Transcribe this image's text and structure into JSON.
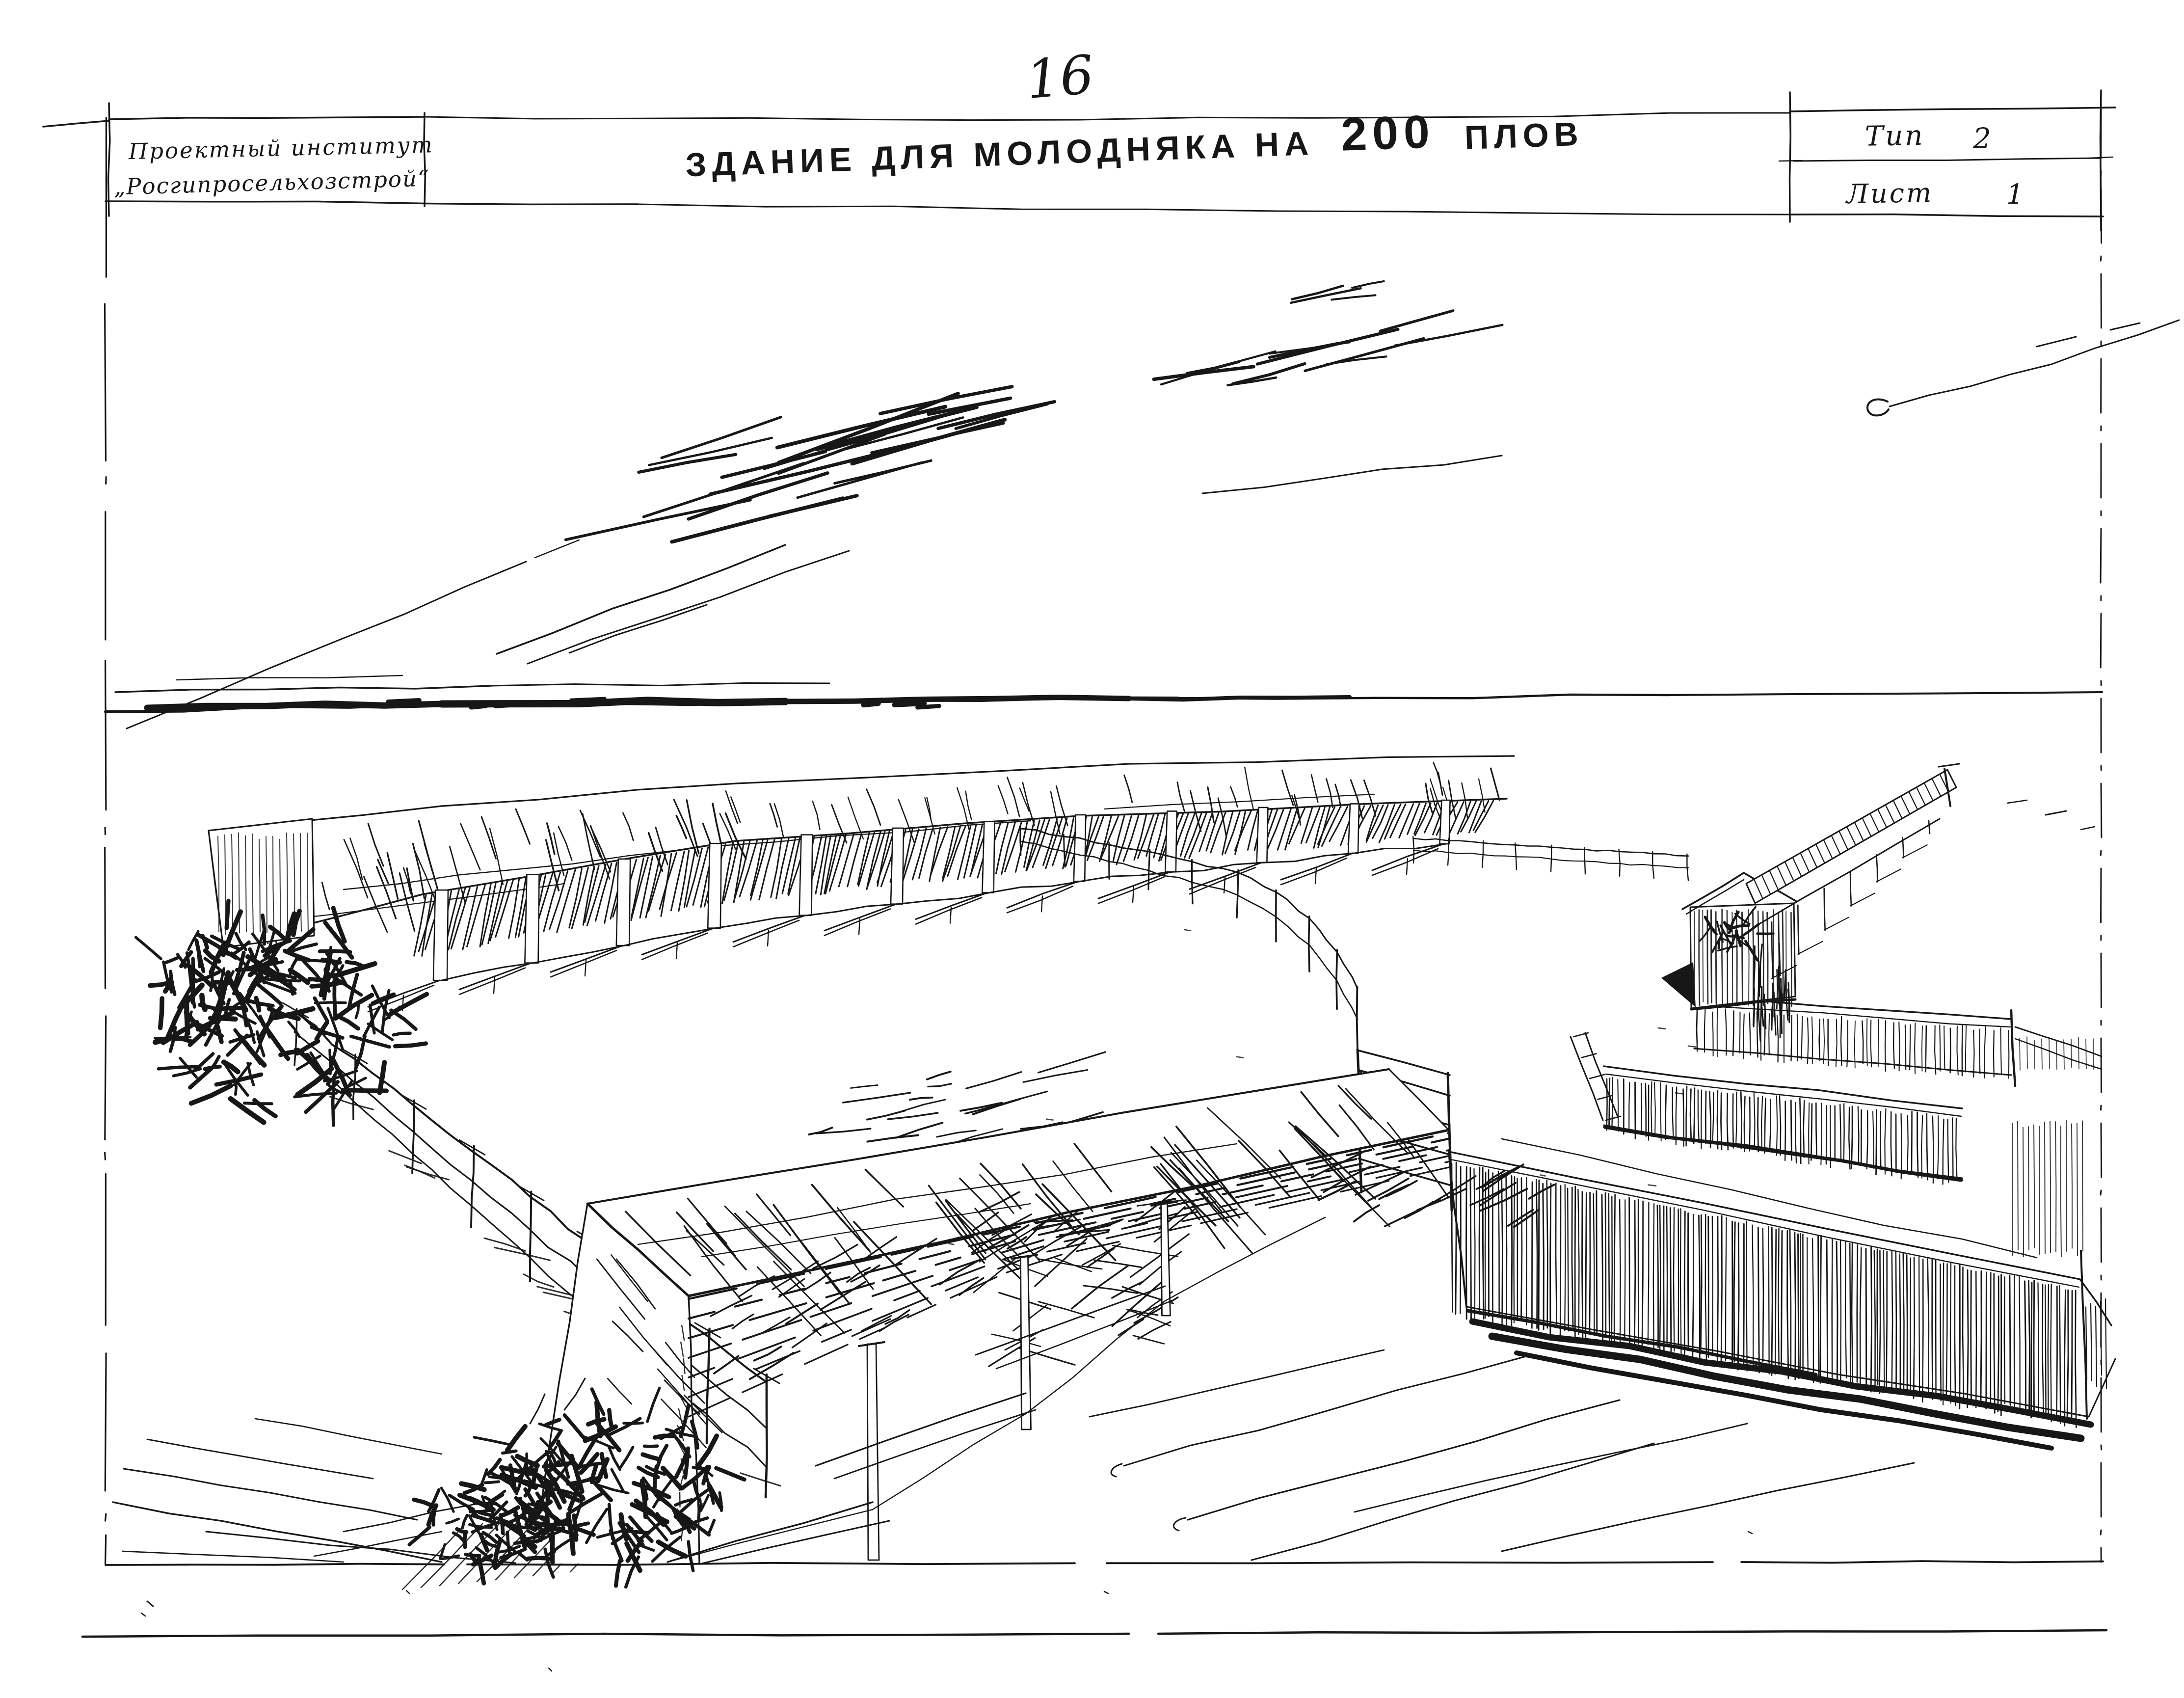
{
  "page": {
    "number": "16"
  },
  "title_block": {
    "institute_line1": "Проектный институт",
    "institute_line2": "„Росгипросельхозстрой“",
    "type_label": "Тип",
    "type_value": "2",
    "sheet_label": "Лист",
    "sheet_value": "1"
  },
  "drawing_title": {
    "part1": "ЗДАНИЕ ДЛЯ МОЛОДНЯКА НА",
    "part2": "200",
    "part3": "ПЛОВ",
    "full_text": "ЗДАНИЕ ДЛЯ МОЛОДНЯКА НА 200 ПЛОВ"
  },
  "colors": {
    "paper": "#ffffff",
    "ink": "#171717"
  }
}
